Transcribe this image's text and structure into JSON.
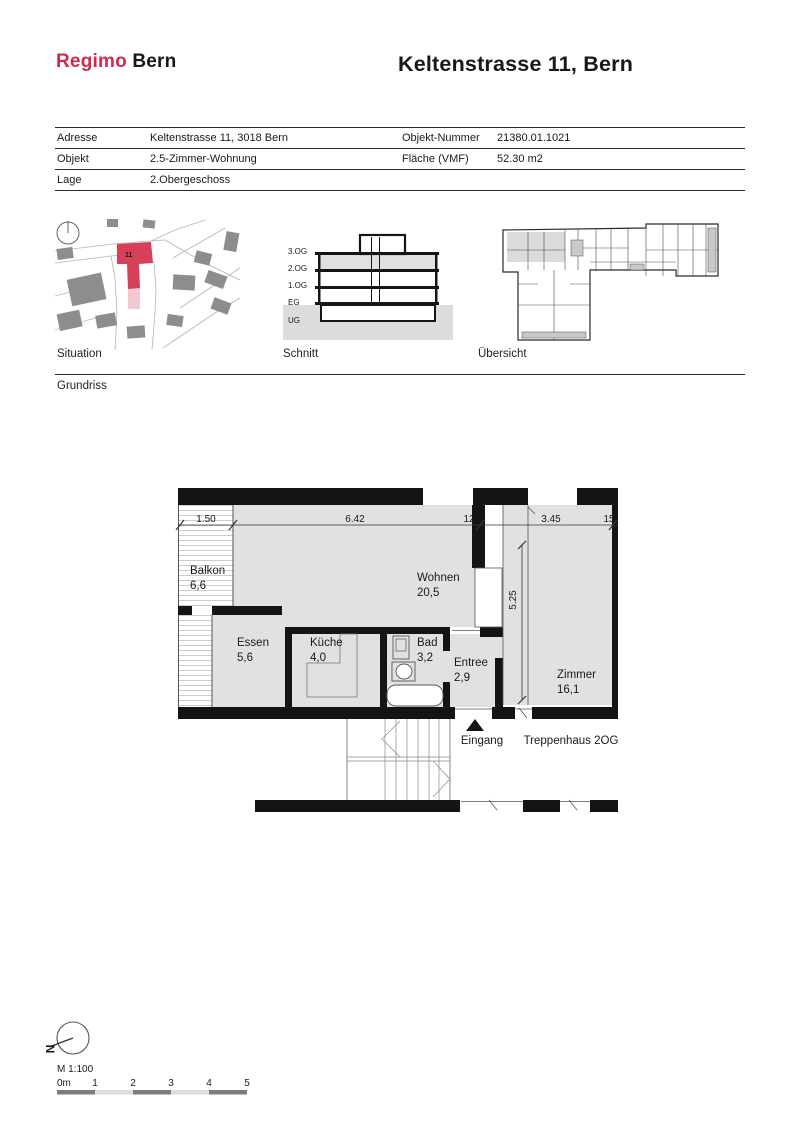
{
  "header": {
    "logo_primary": "Regimo",
    "logo_secondary": "Bern",
    "title": "Keltenstrasse 11, Bern"
  },
  "info_table": {
    "rows": [
      {
        "label": "Adresse",
        "value": "Keltenstrasse 11, 3018 Bern",
        "label2": "Objekt-Nummer",
        "value2": "21380.01.1021"
      },
      {
        "label": "Objekt",
        "value": "2.5-Zimmer-Wohnung",
        "label2": "Fläche (VMF)",
        "value2": "52.30 m2"
      },
      {
        "label": "Lage",
        "value": "2.Obergeschoss",
        "label2": "",
        "value2": ""
      }
    ]
  },
  "figures": {
    "situation": {
      "label": "Situation",
      "building_number": "11"
    },
    "schnitt": {
      "label": "Schnitt",
      "floors": [
        "3.OG",
        "2.OG",
        "1.OG",
        "EG",
        "UG"
      ]
    },
    "uebersicht": {
      "label": "Übersicht"
    }
  },
  "section": {
    "label": "Grundriss"
  },
  "floorplan": {
    "rooms": [
      {
        "name": "Balkon",
        "area": "6,6"
      },
      {
        "name": "Wohnen",
        "area": "20,5"
      },
      {
        "name": "Essen",
        "area": "5,6"
      },
      {
        "name": "Küche",
        "area": "4,0"
      },
      {
        "name": "Bad",
        "area": "3,2"
      },
      {
        "name": "Entree",
        "area": "2,9"
      },
      {
        "name": "Zimmer",
        "area": "16,1"
      }
    ],
    "dimensions": {
      "balkon_width": "1.50",
      "wohnen_width": "6.42",
      "wall_a": "12",
      "zimmer_width": "3.45",
      "wall_b": "15",
      "depth": "5.25"
    },
    "entrance_label": "Eingang",
    "stairwell_label": "Treppenhaus 2OG"
  },
  "footer": {
    "north_label": "N",
    "scale_label": "M 1:100",
    "scale_ticks": [
      "0m",
      "1",
      "2",
      "3",
      "4",
      "5"
    ]
  },
  "colors": {
    "accent_red": "#ce2b4f",
    "map_red": "#d64059",
    "map_pink": "#f2c9ce",
    "map_building_gray": "#8d8d8d",
    "room_fill": "#e1e1e1",
    "wall": "#141414",
    "floor_highlight": "#e0e0e0",
    "scalebar_dark": "#7c7c7c",
    "scalebar_light": "#dedede"
  }
}
